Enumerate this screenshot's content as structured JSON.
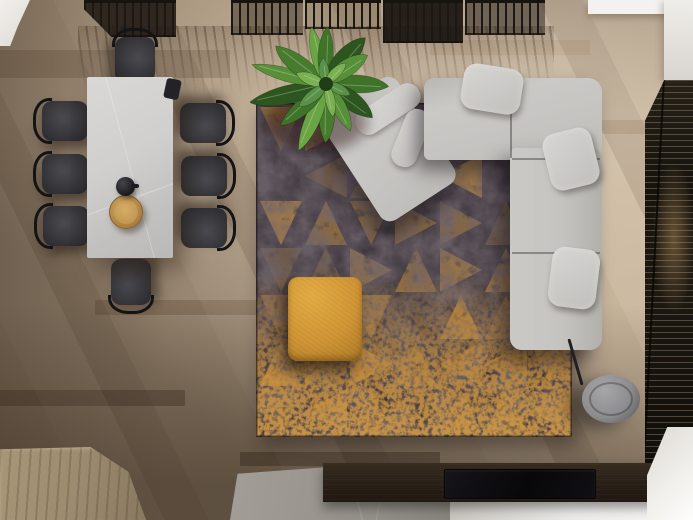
{
  "scene": {
    "description": "Top-down 3D render of a modern living room with a dining area, sectional sofa on a patterned rug, plant and media wall",
    "view": "bird's-eye"
  },
  "objects": {
    "floor": {
      "label": "Wood plank floor"
    },
    "slat_partition": {
      "label": "Black slatted partition"
    },
    "white_wall": {
      "label": "White wall corner"
    },
    "dining_table": {
      "label": "Stone dining table"
    },
    "dining_chair": {
      "label": "Black dining chair"
    },
    "tray": {
      "label": "Round wooden tray"
    },
    "teapot": {
      "label": "Black teapot"
    },
    "rug": {
      "label": "Distressed triangle-pattern rug"
    },
    "sofa": {
      "label": "Light gray L-shaped sectional sofa"
    },
    "pillow": {
      "label": "Sofa pillow"
    },
    "pouf": {
      "label": "Mustard yellow ottoman"
    },
    "plant": {
      "label": "Banana plant"
    },
    "floor_lamp": {
      "label": "Gray drum floor lamp"
    },
    "blinds": {
      "label": "Window blinds"
    },
    "media_console": {
      "label": "Dark wood media console"
    },
    "tv_panel": {
      "label": "Black TV panel"
    },
    "stone_slab": {
      "label": "Gray stone bench"
    },
    "white_floor": {
      "label": "Light floor strip"
    },
    "wood_platform": {
      "label": "Light wood platform"
    },
    "white_cabinet": {
      "label": "White cabinet"
    }
  },
  "palette": {
    "floor_light": "#c7b49b",
    "floor_mid": "#a8937b",
    "floor_dark": "#5e4e40",
    "rug_base": "#3a3339",
    "rug_gold": "#c98f3a",
    "sofa_gray": "#c6c4c1",
    "pillow_gray": "#d8d6d3",
    "pouf_amber": "#d09232",
    "plant_green": "#3f7329",
    "table_stone": "#d2d1cf",
    "chair_black": "#323236",
    "console_wood": "#2b2219",
    "slat_black": "#1b1712",
    "cabinet_white": "#f0eeea",
    "stone_gray": "#95918a",
    "lamp_gray": "#8d8d90"
  },
  "counts": {
    "dining_chairs": 8,
    "sofa_pillows": 3,
    "rug_rows": 7,
    "rug_cols": 7,
    "plant_leaves": 13
  }
}
